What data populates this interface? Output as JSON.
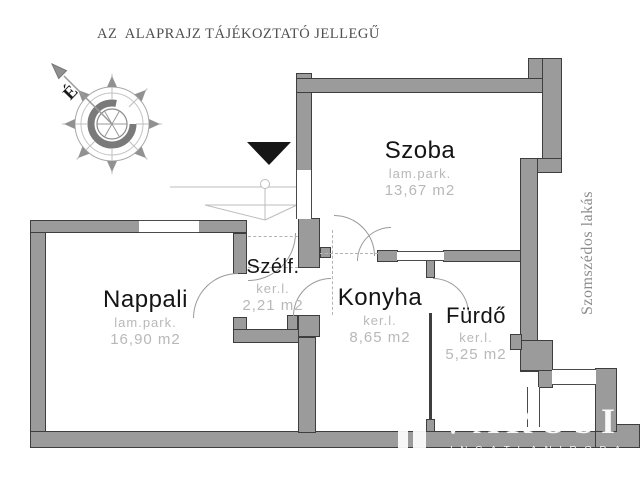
{
  "title": "AZ  ALAPRAJZ TÁJÉKOZTATÓ JELLEGŰ",
  "compass": {
    "north_label": "É"
  },
  "rooms": [
    {
      "id": "szoba",
      "name": "Szoba",
      "floor": "lam.park.",
      "area": "13,67  m2"
    },
    {
      "id": "nappali",
      "name": "Nappali",
      "floor": "lam.park.",
      "area": "16,90  m2"
    },
    {
      "id": "szelfogo",
      "name": "Szélf.",
      "floor": "ker.l.",
      "area": "2,21  m2"
    },
    {
      "id": "konyha",
      "name": "Konyha",
      "floor": "ker.l.",
      "area": "8,65  m2"
    },
    {
      "id": "furdo",
      "name": "Fürdő",
      "floor": "ker.l.",
      "area": "5,25  m2"
    }
  ],
  "neighbor_label": "Szomszédos lakás",
  "watermark": {
    "name": "VÁROSI",
    "subtitle": "INGATLANIRODA"
  },
  "colors": {
    "wall": "#9b9b9b",
    "wall_outline": "#3e3e3e",
    "room_text": "#141414",
    "muted_text": "#b8b8b8",
    "entrance_marker": "#161616"
  }
}
